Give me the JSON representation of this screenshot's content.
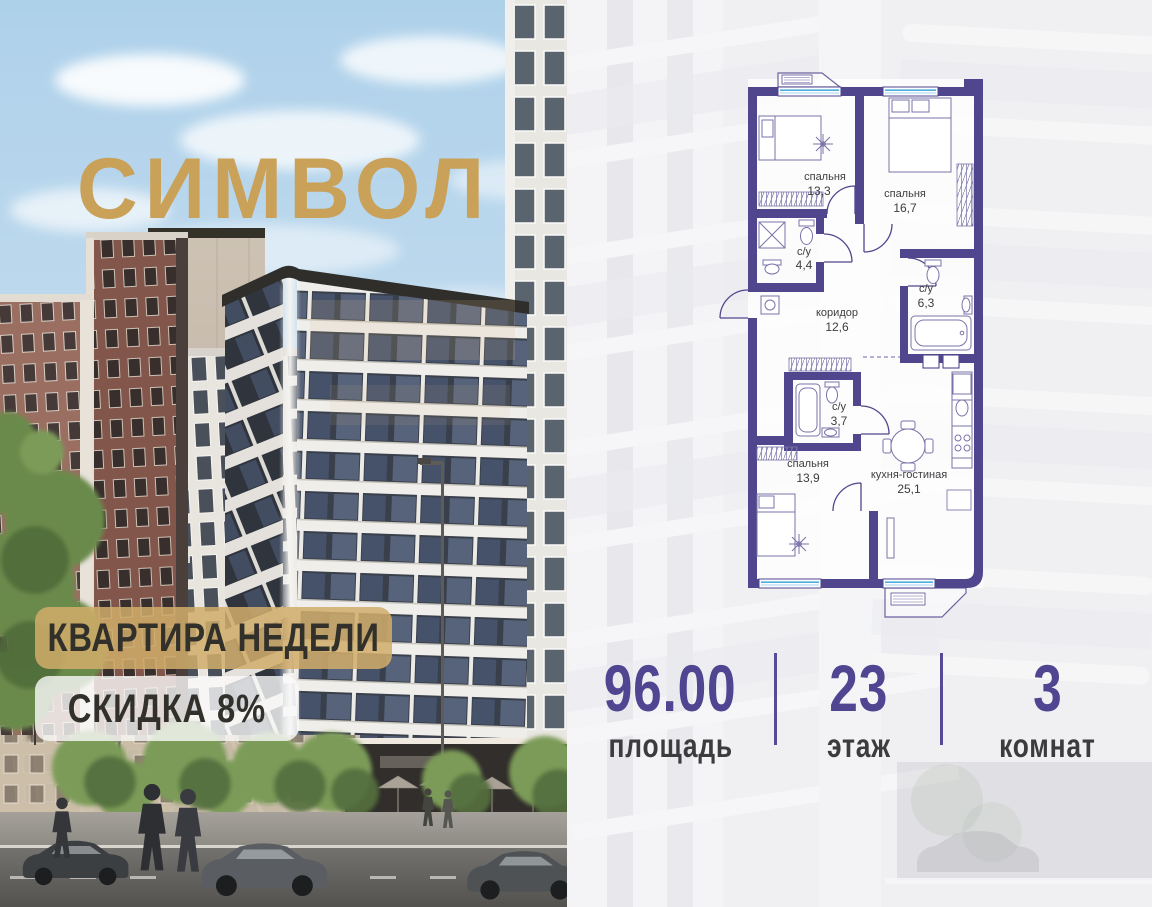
{
  "brand": {
    "name": "СИМВОЛ"
  },
  "badges": {
    "apartment_of_week": "КВАРТИРА НЕДЕЛИ",
    "discount": "СКИДКА 8%"
  },
  "floor_plan": {
    "rooms": [
      {
        "name": "спальня",
        "area": "13,3"
      },
      {
        "name": "спальня",
        "area": "16,7"
      },
      {
        "name": "с/у",
        "area": "4,4"
      },
      {
        "name": "с/у",
        "area": "6,3"
      },
      {
        "name": "коридор",
        "area": "12,6"
      },
      {
        "name": "с/у",
        "area": "3,7"
      },
      {
        "name": "спальня",
        "area": "13,9"
      },
      {
        "name": "кухня-гостиная",
        "area": "25,1"
      }
    ],
    "wall_color": "#50468D",
    "window_color": "#4FAEDC"
  },
  "stats": [
    {
      "value": "96.00",
      "label": "площадь"
    },
    {
      "value": "23",
      "label": "этаж"
    },
    {
      "value": "3",
      "label": "комнат"
    }
  ],
  "colors": {
    "gold": "#C9A158",
    "stat_number": "#4F4590",
    "divider": "#554B96"
  }
}
